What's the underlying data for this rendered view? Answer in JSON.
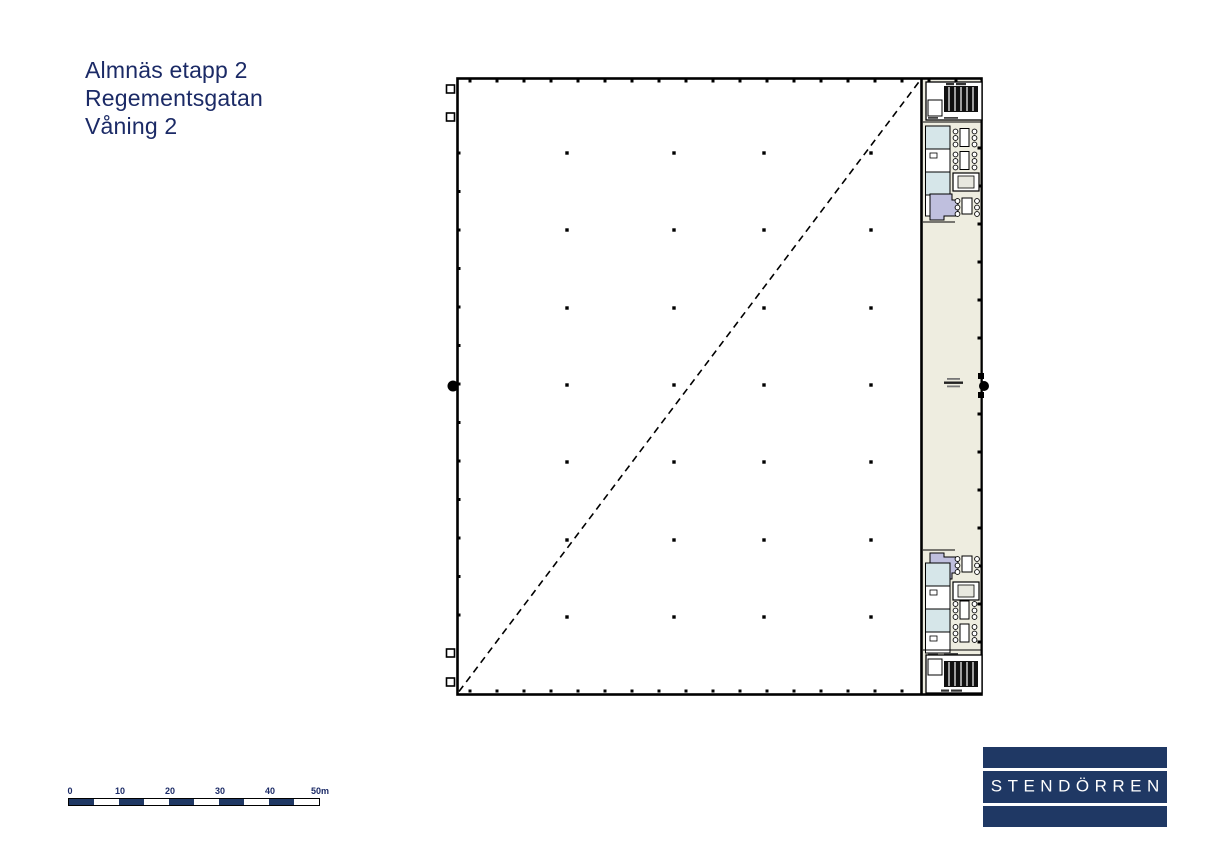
{
  "title_block": {
    "lines": [
      "Almnäs etapp 2",
      "Regementsgatan",
      "Våning 2"
    ]
  },
  "scale_bar": {
    "tick_labels": [
      "0",
      "10",
      "20",
      "30",
      "40",
      "50m"
    ],
    "total_length_m": 50
  },
  "logo": {
    "name": "STENDÖRREN"
  },
  "colors": {
    "brand_navy": "#1f3864",
    "title_text": "#1b2a66",
    "wall_black": "#000000",
    "room_light_blue": "#d6e6e9",
    "stair_lavender": "#bfbfde",
    "corridor_beige": "#eeede0"
  }
}
